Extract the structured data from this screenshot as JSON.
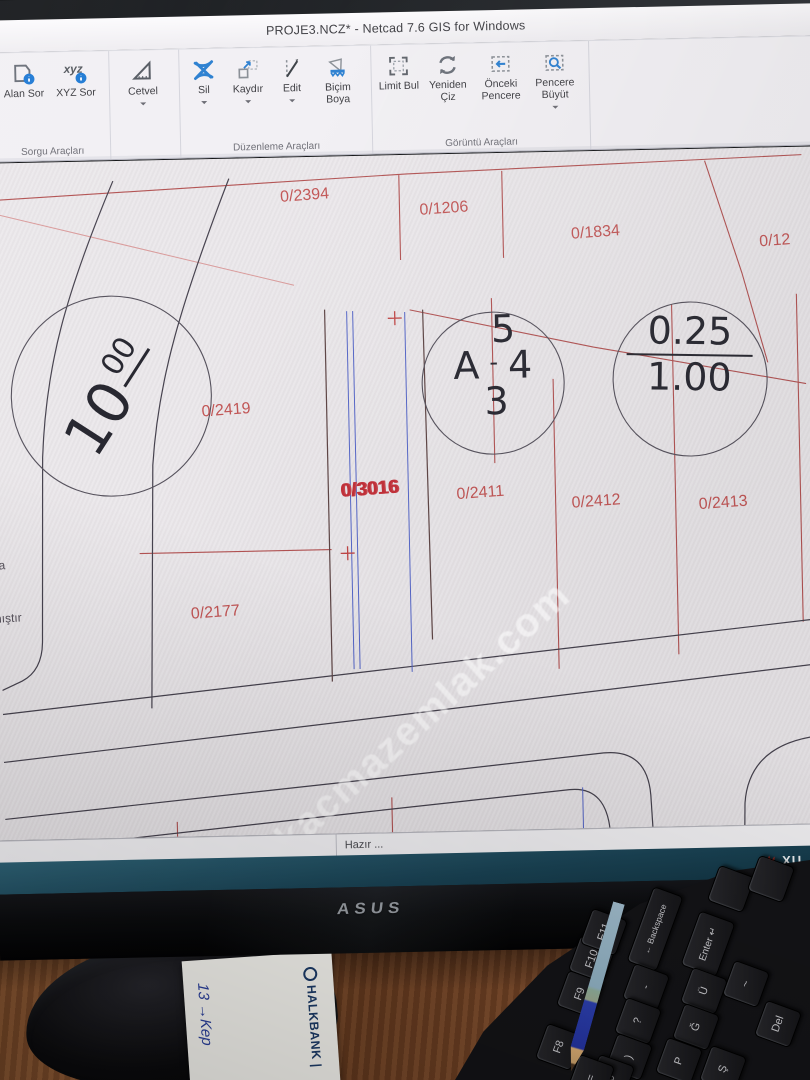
{
  "window": {
    "title": "PROJE3.NCZ* - Netcad 7.6 GIS for Windows"
  },
  "ribbon": {
    "groups": [
      {
        "label": "Sorgu Araçları",
        "buttons": [
          {
            "label": "Alan Sor"
          },
          {
            "label": "XYZ Sor"
          }
        ]
      },
      {
        "label": "",
        "buttons": [
          {
            "label": "Cetvel"
          }
        ]
      },
      {
        "label": "Düzenleme Araçları",
        "buttons": [
          {
            "label": "Sil"
          },
          {
            "label": "Kaydır"
          },
          {
            "label": "Edit"
          },
          {
            "label": "Biçim Boya"
          }
        ]
      },
      {
        "label": "Görüntü Araçları",
        "buttons": [
          {
            "label": "Limit Bul"
          },
          {
            "label": "Yeniden Çiz"
          },
          {
            "label": "Önceki Pencere"
          },
          {
            "label": "Pencere Büyüt"
          }
        ]
      }
    ]
  },
  "map": {
    "watermark": "kacmazemlak.com",
    "parcels": [
      {
        "label": "0/2394"
      },
      {
        "label": "0/1206"
      },
      {
        "label": "0/1834"
      },
      {
        "label": "0/12"
      },
      {
        "label": "8"
      },
      {
        "label": "0/2419"
      },
      {
        "label": "0/3016"
      },
      {
        "label": "0/2411"
      },
      {
        "label": "0/2412"
      },
      {
        "label": "0/2413"
      },
      {
        "label": "0/2177"
      }
    ],
    "edge_texts": [
      {
        "text": "ora"
      },
      {
        "text": "nmıştır"
      }
    ],
    "circle_left": {
      "main": "10",
      "sup": "00"
    },
    "circle_mid": {
      "top": "5",
      "left": "A",
      "dash": "-",
      "right": "4",
      "bottom": "3"
    },
    "circle_right": {
      "top": "0.25",
      "bottom": "1.00"
    }
  },
  "statusbar": {
    "text": "Hazır ..."
  },
  "branding": {
    "monitor": "ASUS",
    "taskbar_text": "XU"
  },
  "desk": {
    "paper_brand": "HALKBANK",
    "paper_brand_mark": "|",
    "paper_note": "13 →Kep",
    "keys": [
      {
        "label": "F8"
      },
      {
        "label": "F9"
      },
      {
        "label": "F10"
      },
      {
        "label": "F11"
      },
      {
        "label": "← Backspace"
      },
      {
        "label": "Enter ↵"
      },
      {
        "label": "-"
      },
      {
        "label": "?"
      },
      {
        "label": ")"
      },
      {
        "label": "0"
      },
      {
        "label": "="
      },
      {
        "label": "Ü"
      },
      {
        "label": "Ğ"
      },
      {
        "label": "P"
      },
      {
        "label": "Ş"
      },
      {
        "label": "~"
      },
      {
        "label": "Del"
      }
    ]
  }
}
